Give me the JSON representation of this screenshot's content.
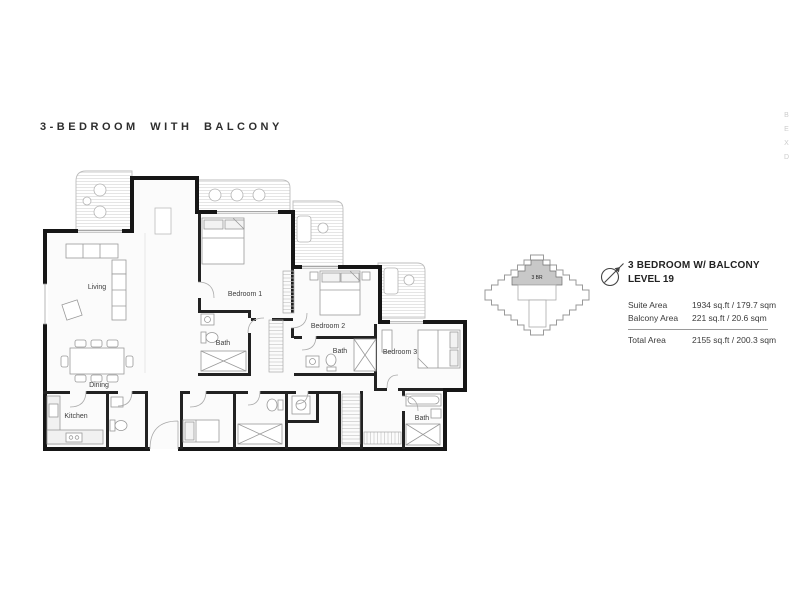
{
  "page": {
    "title": "3-BEDROOM WITH BALCONY",
    "edge_text": "BEXD"
  },
  "key_plan": {
    "unit_label": "3 BR"
  },
  "info": {
    "name": "3 BEDROOM W/ BALCONY",
    "level": "LEVEL 19",
    "rows": [
      {
        "label": "Suite Area",
        "value": "1934 sq.ft / 179.7 sqm"
      },
      {
        "label": "Balcony Area",
        "value": "221 sq.ft / 20.6 sqm"
      }
    ],
    "total": {
      "label": "Total Area",
      "value": "2155 sq.ft / 200.3 sqm"
    }
  },
  "floor_plan": {
    "rooms": [
      {
        "label": "Living"
      },
      {
        "label": "Dining"
      },
      {
        "label": "Kitchen"
      },
      {
        "label": "Bedroom 1"
      },
      {
        "label": "Bath"
      },
      {
        "label": "Bedroom 2"
      },
      {
        "label": "Bath"
      },
      {
        "label": "Bedroom 3"
      },
      {
        "label": "Bath"
      }
    ]
  },
  "colors": {
    "wall": "#1a1a1a",
    "unit_highlight": "#c8c8c8",
    "text": "#333333",
    "faint": "#cccccc"
  }
}
